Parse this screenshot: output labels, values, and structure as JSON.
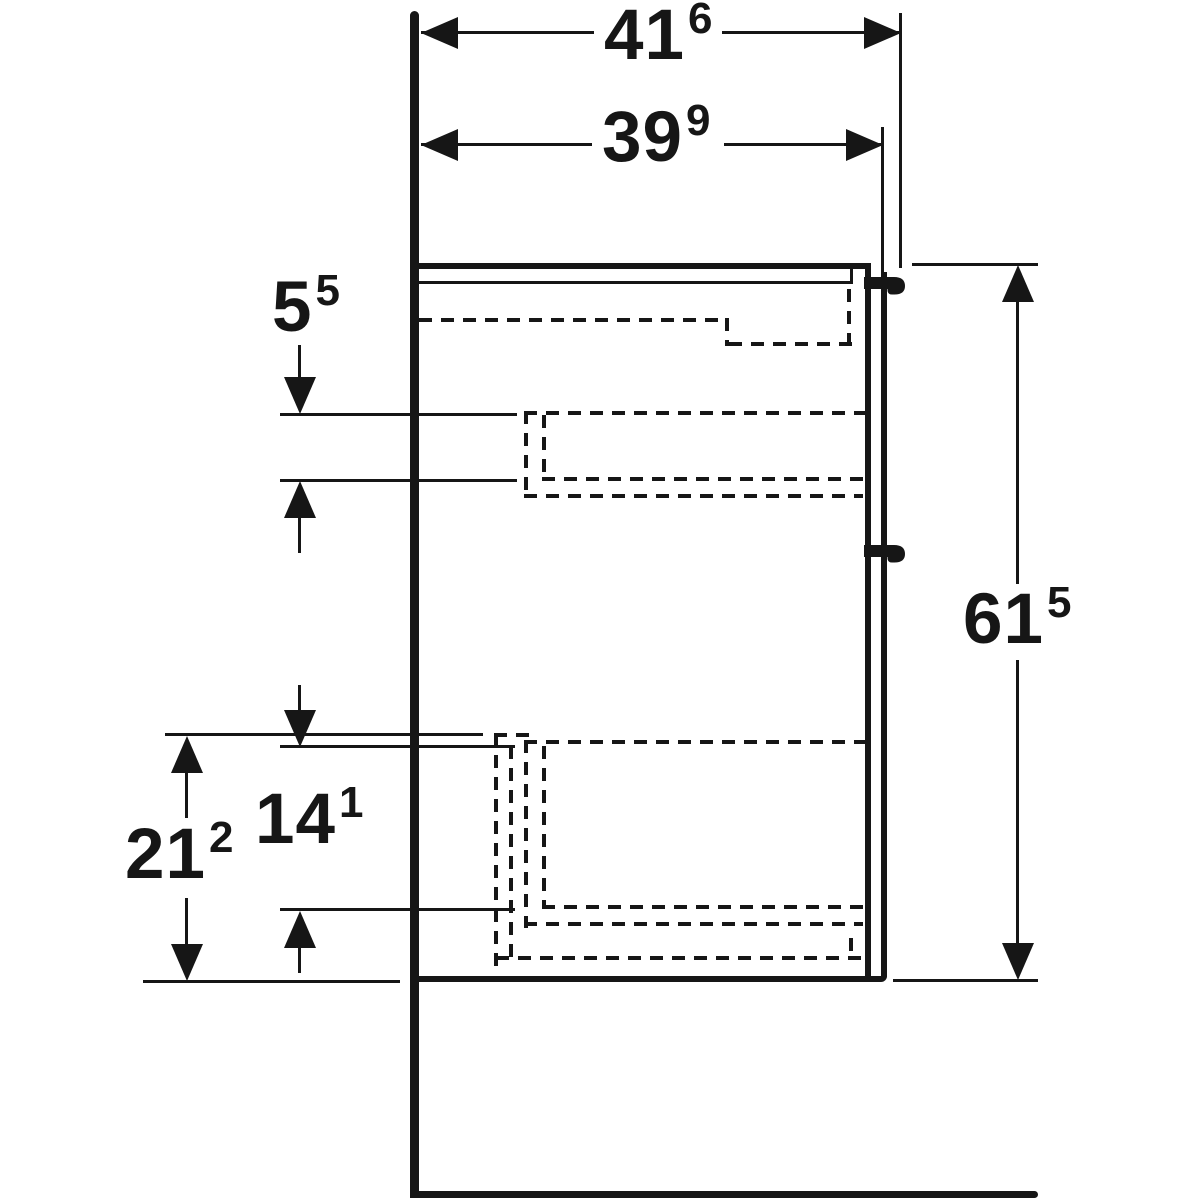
{
  "page": {
    "background": "#ffffff",
    "line_color": "#161616",
    "drawing_type": "vanity cabinet side-view dimension drawing"
  },
  "dims": {
    "depth_with_handle": {
      "main": "41",
      "sup": "6"
    },
    "depth_without_handle": {
      "main": "39",
      "sup": "9"
    },
    "upper_drawer_inner_height": {
      "main": "5",
      "sup": "5"
    },
    "overall_height": {
      "main": "61",
      "sup": "5"
    },
    "lower_section_height": {
      "main": "21",
      "sup": "2"
    },
    "lower_drawer_inner_height": {
      "main": "14",
      "sup": "1"
    }
  }
}
